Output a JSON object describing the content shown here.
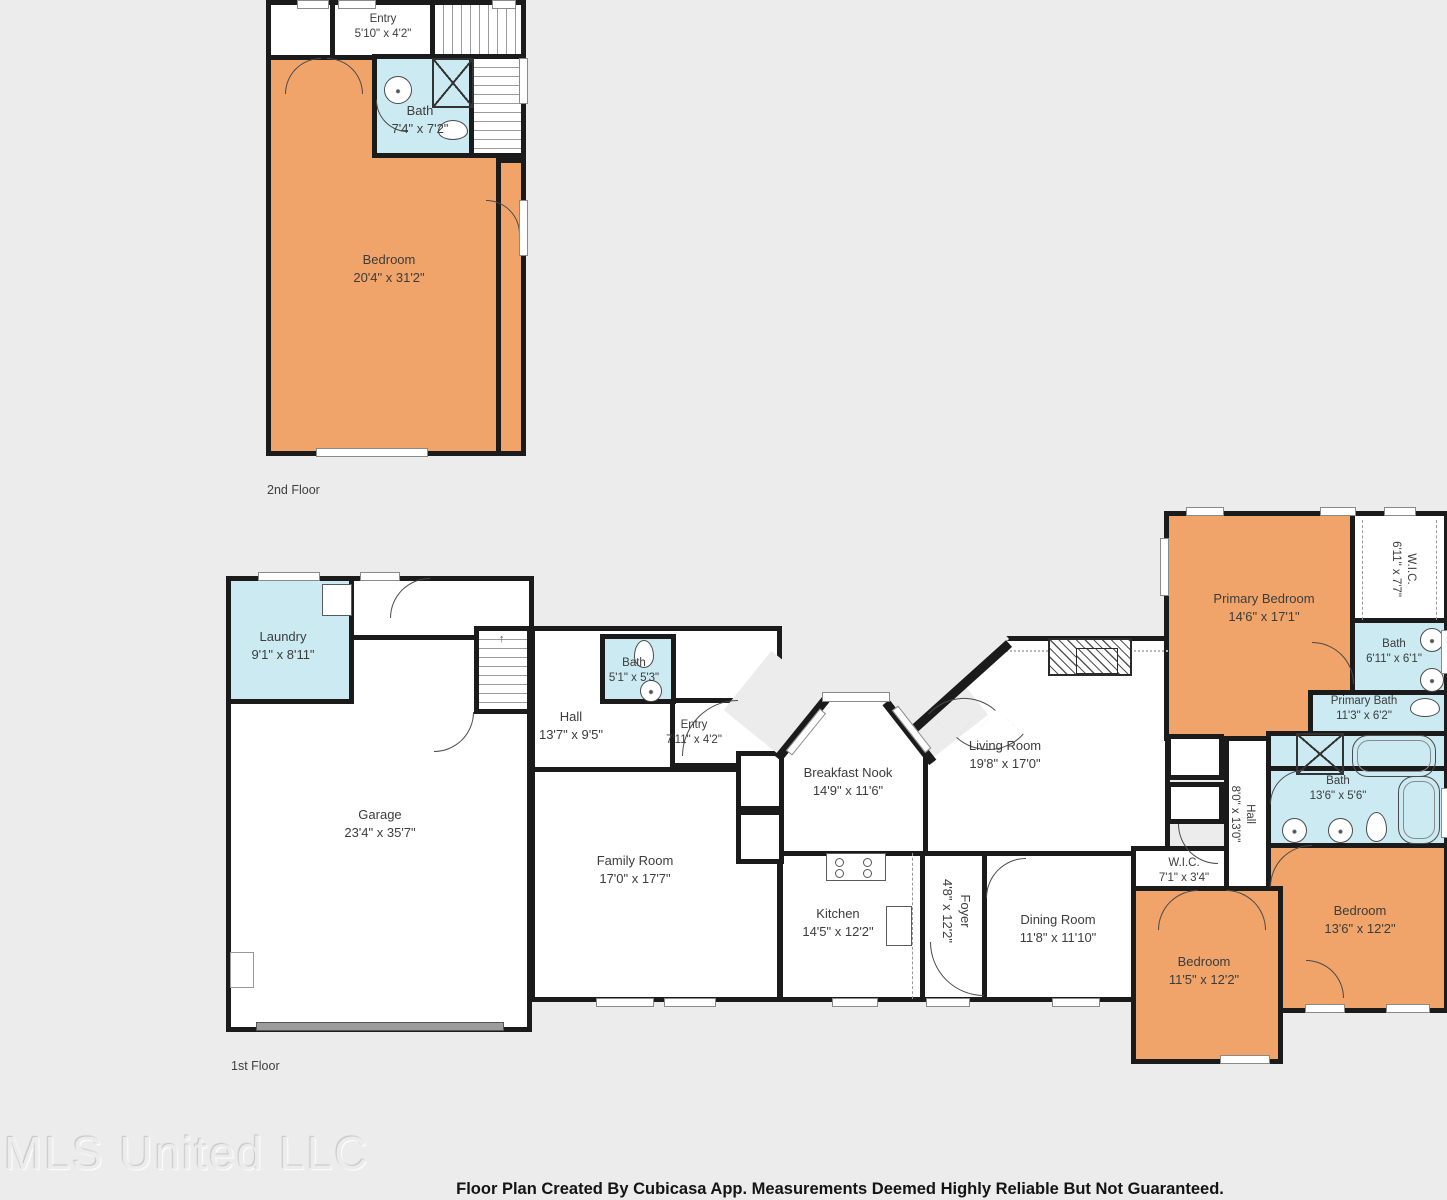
{
  "floors": {
    "second": {
      "label": "2nd Floor",
      "rooms": {
        "entry": {
          "name": "Entry",
          "dims": "5'10\" x 4'2\""
        },
        "bath": {
          "name": "Bath",
          "dims": "7'4\" x 7'2\""
        },
        "bedroom": {
          "name": "Bedroom",
          "dims": "20'4\" x 31'2\""
        }
      }
    },
    "first": {
      "label": "1st Floor",
      "rooms": {
        "laundry": {
          "name": "Laundry",
          "dims": "9'1\" x 8'11\""
        },
        "garage": {
          "name": "Garage",
          "dims": "23'4\" x 35'7\""
        },
        "hall": {
          "name": "Hall",
          "dims": "13'7\" x 9'5\""
        },
        "bath": {
          "name": "Bath",
          "dims": "5'1\" x 5'3\""
        },
        "entry": {
          "name": "Entry",
          "dims": "7'11\" x 4'2\""
        },
        "breakfast_nook": {
          "name": "Breakfast Nook",
          "dims": "14'9\" x 11'6\""
        },
        "living_room": {
          "name": "Living Room",
          "dims": "19'8\" x 17'0\""
        },
        "family_room": {
          "name": "Family Room",
          "dims": "17'0\" x 17'7\""
        },
        "kitchen": {
          "name": "Kitchen",
          "dims": "14'5\" x 12'2\""
        },
        "foyer": {
          "name": "Foyer",
          "dims": "4'8\" x 12'2\""
        },
        "dining_room": {
          "name": "Dining Room",
          "dims": "11'8\" x 11'10\""
        },
        "wic": {
          "name": "W.I.C.",
          "dims": "7'1\" x 3'4\""
        },
        "hall2": {
          "name": "Hall",
          "dims": "8'0\" x 13'0\""
        },
        "primary_bedroom": {
          "name": "Primary Bedroom",
          "dims": "14'6\" x 17'1\""
        },
        "wic2": {
          "name": "W.I.C.",
          "dims": "6'11\" x 7'7\""
        },
        "bath2": {
          "name": "Bath",
          "dims": "6'11\" x 6'1\""
        },
        "primary_bath": {
          "name": "Primary Bath",
          "dims": "11'3\" x 6'2\""
        },
        "bath3": {
          "name": "Bath",
          "dims": "13'6\" x 5'6\""
        },
        "bedroom_right": {
          "name": "Bedroom",
          "dims": "13'6\" x 12'2\""
        },
        "bedroom_left": {
          "name": "Bedroom",
          "dims": "11'5\" x 12'2\""
        }
      }
    }
  },
  "icons": {
    "stairs_arrow": "↑"
  },
  "footer": {
    "watermark": "MLS United LLC",
    "disclaimer": "Floor Plan Created By Cubicasa App. Measurements Deemed Highly Reliable But Not Guaranteed."
  },
  "colors": {
    "bedroom_fill": "#f0a469",
    "wet_room_fill": "#cbeaf2",
    "wall": "#1b1b1b",
    "background": "#ececec"
  }
}
